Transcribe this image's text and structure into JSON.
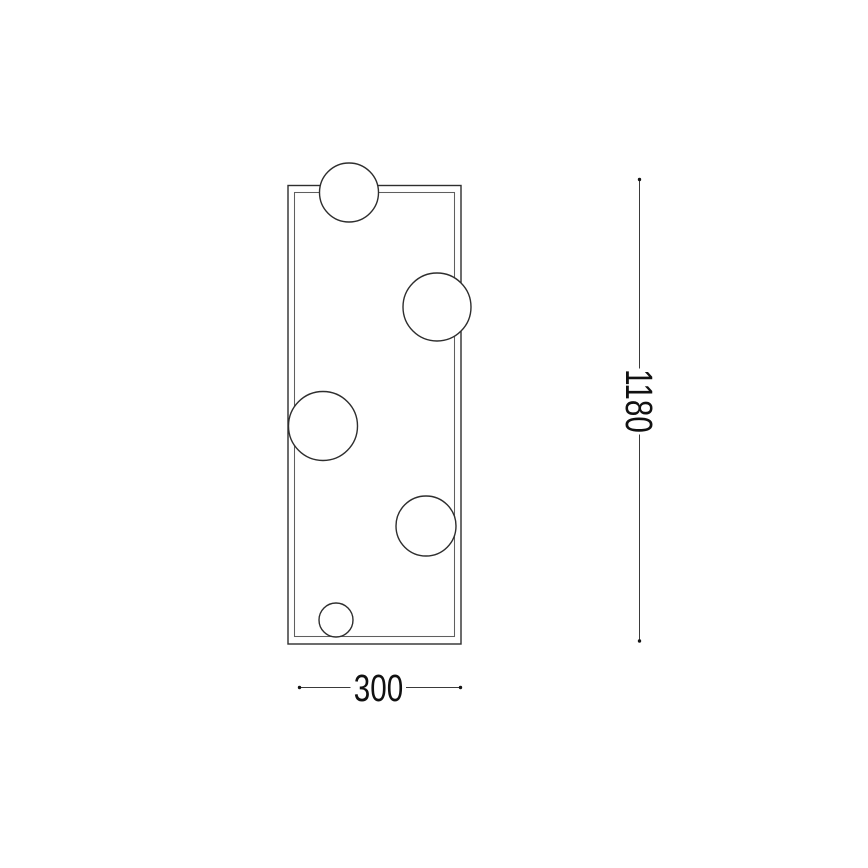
{
  "page": {
    "background_color": "#ffffff",
    "kind": "technical dimension drawing"
  },
  "diagram": {
    "description": "Front-view line drawing of a tall rectangular frame fixture with five spherical globes overlapping its edges, annotated with overall height and width dimensions.",
    "colors": {
      "line": "#2e2e2e",
      "inner_line": "#5f5f5f",
      "dimension_line": "#3a3a3a",
      "dimension_dot": "#141414",
      "text": "#111111",
      "background": "#ffffff",
      "sphere_fill": "#ffffff"
    },
    "frame": {
      "outer": {
        "x": 288,
        "y": 185.5,
        "width": 173,
        "height": 458.5
      },
      "inner": {
        "x": 294.5,
        "y": 192.5,
        "width": 160,
        "height": 444
      }
    },
    "spheres": [
      {
        "cx": 349,
        "cy": 192.5,
        "r": 29.5
      },
      {
        "cx": 437,
        "cy": 307,
        "r": 34
      },
      {
        "cx": 323,
        "cy": 426,
        "r": 34.5
      },
      {
        "cx": 426,
        "cy": 526,
        "r": 30
      },
      {
        "cx": 336,
        "cy": 620,
        "r": 17
      }
    ],
    "dimensions": {
      "height": {
        "label": "1180",
        "orientation": "vertical",
        "x": 639.5,
        "start_y": 179.5,
        "end_y": 641,
        "segments": [
          [
            179.5,
            368.5
          ],
          [
            434.5,
            641
          ]
        ],
        "label_center_y": 401,
        "end_dot_radius": 1.7
      },
      "width": {
        "label": "300",
        "orientation": "horizontal",
        "y": 687.5,
        "start_x": 299.5,
        "end_x": 460.5,
        "segments": [
          [
            299.5,
            350.5
          ],
          [
            406,
            460.5
          ]
        ],
        "label_center_x": 378.5,
        "end_dot_radius": 1.7
      }
    }
  }
}
